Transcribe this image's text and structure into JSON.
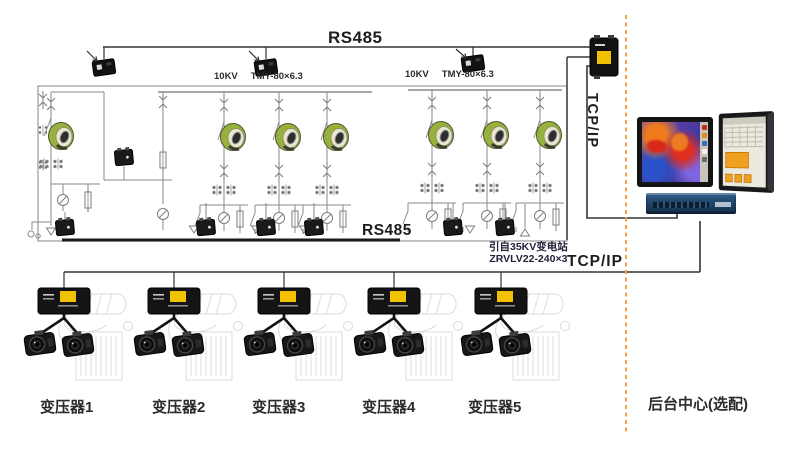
{
  "bus": {
    "rs485_top": "RS485",
    "rs485_field": "RS485",
    "tcpip_link_vertical": "TCP/IP",
    "tcpip_field": "TCP/IP"
  },
  "specs": {
    "voltage": "10KV",
    "busbar": "TMY-80×6.3",
    "incoming_source": "引自35KV变电站",
    "incoming_cable": "ZRVLV22-240×3"
  },
  "field_devices": {
    "transformers": [
      {
        "label": "变压器1"
      },
      {
        "label": "变压器2"
      },
      {
        "label": "变压器3"
      },
      {
        "label": "变压器4"
      },
      {
        "label": "变压器5"
      }
    ]
  },
  "backend": {
    "label": "后台中心(选配)"
  },
  "colors": {
    "separator_orange": "#F0A14B",
    "device_black": "#151515",
    "device_label_yellow": "#F2C200",
    "ct_ring_green": "#97B13C",
    "schematic_line_gray": "#8A8A8A",
    "switch_navy": "#234A70",
    "thermal_red": "#E02F1E",
    "scada_orange": "#F0A020"
  }
}
